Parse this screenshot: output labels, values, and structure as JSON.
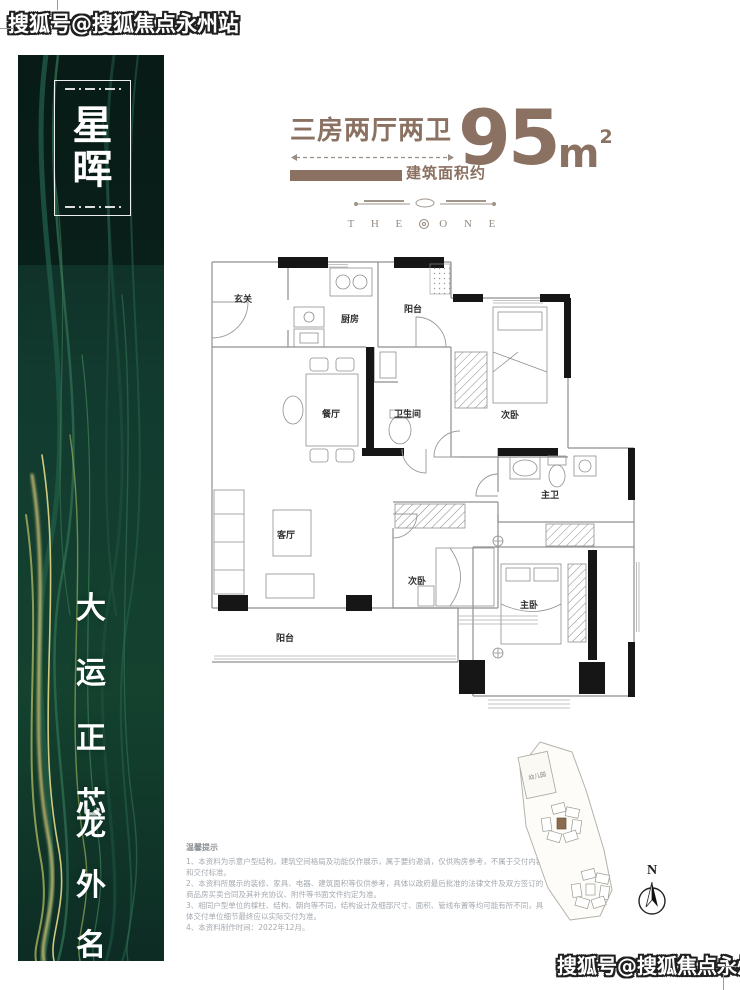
{
  "watermark": {
    "text": "搜狐号@搜狐焦点永州站"
  },
  "sidebar": {
    "badge_chars": [
      "星",
      "晖"
    ],
    "slogan_line1": [
      "大",
      "运",
      "正",
      "芯"
    ],
    "slogan_line2": [
      "龙",
      "外",
      "名",
      "门"
    ]
  },
  "header": {
    "title": "三房两厅两卫",
    "area_label": "建筑面积约",
    "area_number": "95",
    "area_unit": "m",
    "area_exponent": "2",
    "accent_color": "#8a7161"
  },
  "divider": {
    "left": "T H E",
    "right": "O N E"
  },
  "floorplan": {
    "rooms": [
      "玄关",
      "厨房",
      "阳台",
      "餐厅",
      "卫生间",
      "次卧",
      "客厅",
      "次卧",
      "主卫",
      "主卧",
      "阳台"
    ]
  },
  "notes": {
    "title": "温馨提示",
    "items": [
      "1、本资料为示意户型结构，建筑空间格局及功能仅作展示，属于要约邀请，仅供购房参考，不属于交付内容和交付标准。",
      "2、本资料所展示的装修、家具、电器、建筑面积等仅供参考，具体以政府最后批准的法律文件及双方签订的商品房买卖合同及其补充协议、附件等书面文件约定为准。",
      "3、相同户型单位的樑柱、结构、朝向等不同，结构设计及细部尺寸、面积、管线布置等均可能有所不同，具体交付单位细节最终应以实际交付为准。",
      "4、本资料制作时间：2022年12月。"
    ]
  },
  "siteplan": {
    "kindergarten_label": "幼儿园",
    "north_label": "N"
  }
}
